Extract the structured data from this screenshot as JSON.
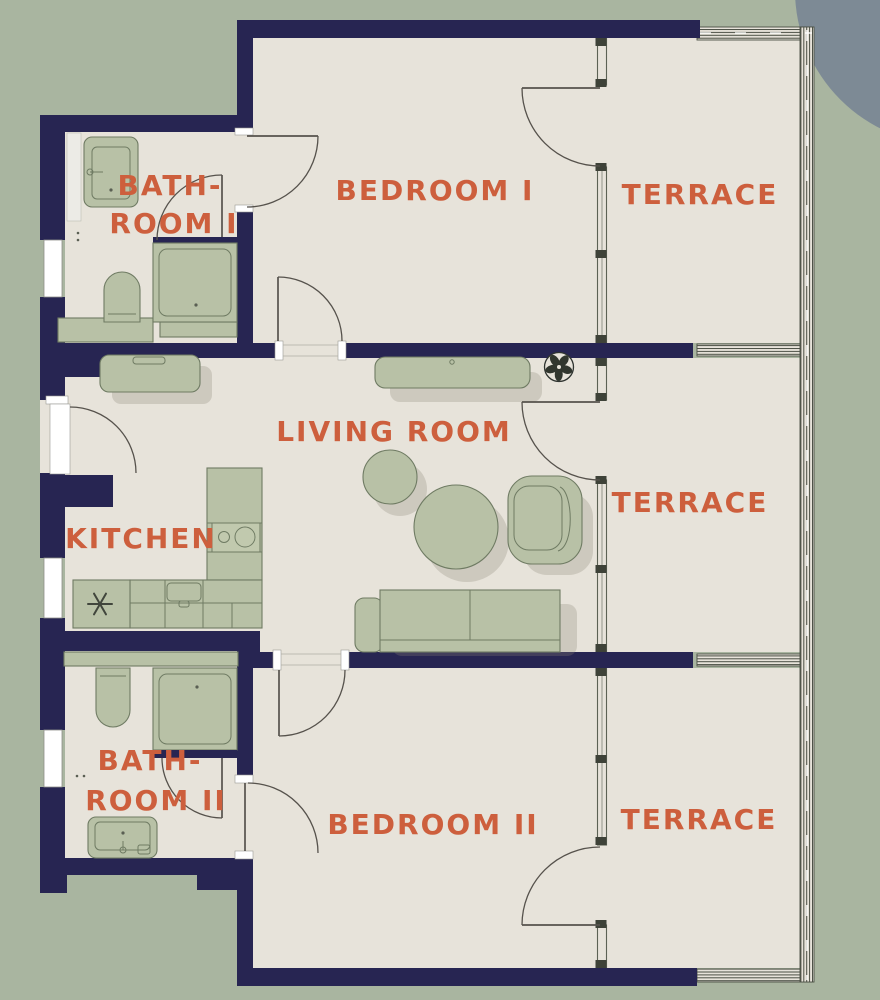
{
  "colors": {
    "background": "#a9b5a0",
    "corner_shape": "#7d8a95",
    "floor": "#e7e3da",
    "wall": "#272552",
    "accent": "#cd5f3d",
    "furniture": "#b8c1a6",
    "furniture_stroke": "#6f7b63",
    "shadow": "#8d8577",
    "glass": "#5c6254",
    "door": "#56524c"
  },
  "rooms": {
    "bathroom1": {
      "line1": "BATH-",
      "line2": "ROOM I"
    },
    "bedroom1": {
      "label": "BEDROOM I"
    },
    "terrace_top": {
      "label": "TERRACE"
    },
    "living_room": {
      "label": "LIVING ROOM"
    },
    "kitchen": {
      "label": "KITCHEN"
    },
    "terrace_middle": {
      "label": "TERRACE"
    },
    "bathroom2": {
      "line1": "BATH-",
      "line2": "ROOM II"
    },
    "bedroom2": {
      "label": "BEDROOM II"
    },
    "terrace_bottom": {
      "label": "TERRACE"
    }
  },
  "icons": {
    "plant_icon": "potted-plant",
    "fridge_icon": "snowflake",
    "stove_icon": "two-burner-cooktop",
    "sink_icon": "washbasin",
    "toilet_icon": "toilet",
    "shower_icon": "shower-tray",
    "sofa_icon": "sofa",
    "armchair_icon": "armchair",
    "table_icon": "round-table",
    "sideboard_icon": "sideboard",
    "door_icon": "door-swing-arc",
    "window_icon": "window",
    "railing_icon": "terrace-railing"
  }
}
